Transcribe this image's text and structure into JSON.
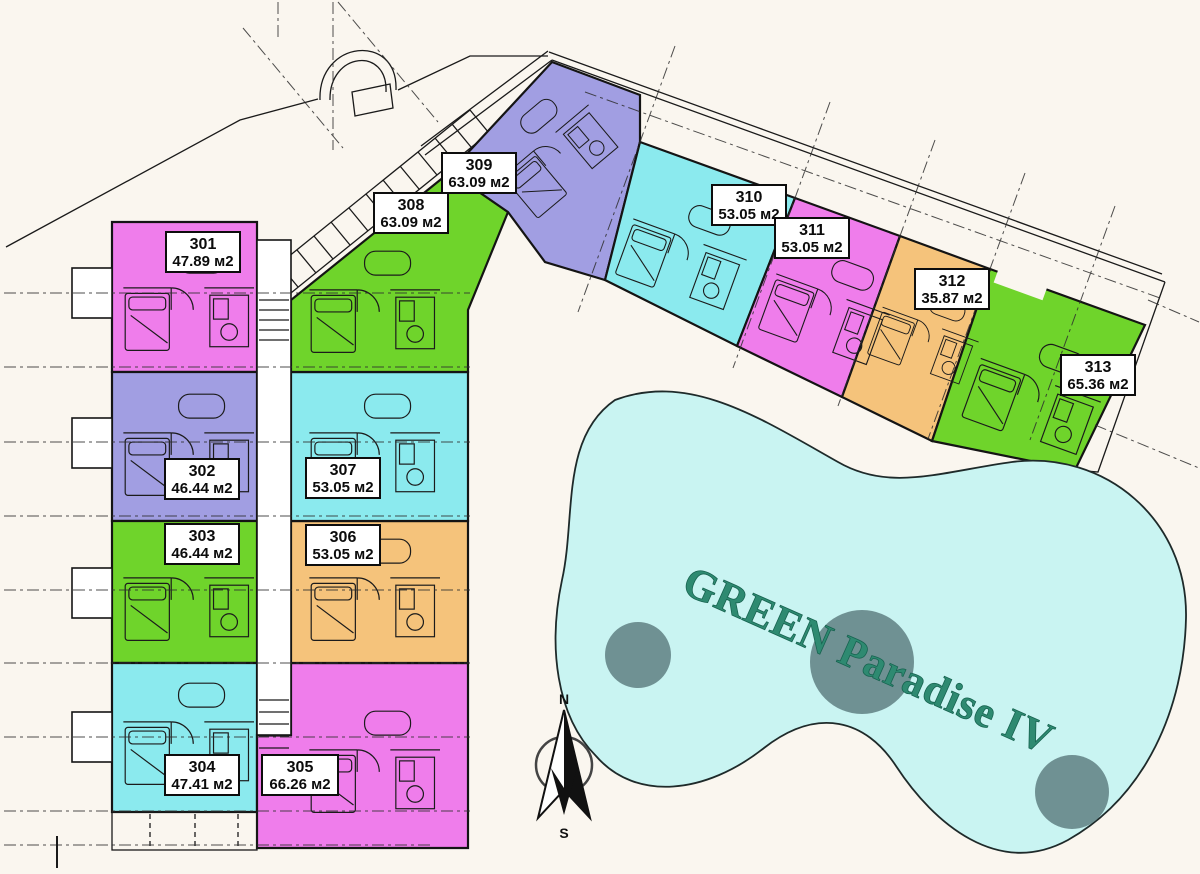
{
  "pool": {
    "label": "GREEN Paradise IV"
  },
  "compass": {
    "north": "N",
    "south": "S"
  },
  "units": [
    {
      "id": "301",
      "area": "47.89 м2",
      "color": "#ef7deb"
    },
    {
      "id": "302",
      "area": "46.44 м2",
      "color": "#a19ee2"
    },
    {
      "id": "303",
      "area": "46.44 м2",
      "color": "#6fd42b"
    },
    {
      "id": "304",
      "area": "47.41 м2",
      "color": "#8beaee"
    },
    {
      "id": "305",
      "area": "66.26 м2",
      "color": "#ef7deb"
    },
    {
      "id": "306",
      "area": "53.05 м2",
      "color": "#f5c37b"
    },
    {
      "id": "307",
      "area": "53.05 м2",
      "color": "#8beaee"
    },
    {
      "id": "308",
      "area": "63.09 м2",
      "color": "#6fd42b"
    },
    {
      "id": "309",
      "area": "63.09 м2",
      "color": "#a19ee2"
    },
    {
      "id": "310",
      "area": "53.05 м2",
      "color": "#8beaee"
    },
    {
      "id": "311",
      "area": "53.05 м2",
      "color": "#ef7deb"
    },
    {
      "id": "312",
      "area": "35.87 м2",
      "color": "#f5c37b"
    },
    {
      "id": "313",
      "area": "65.36 м2",
      "color": "#6fd42b"
    }
  ],
  "palette": {
    "background": "#faf6ef",
    "pool_fill": "#c9f4f2",
    "pool_island": "#6f9193",
    "pool_text": "#2e8a71"
  }
}
